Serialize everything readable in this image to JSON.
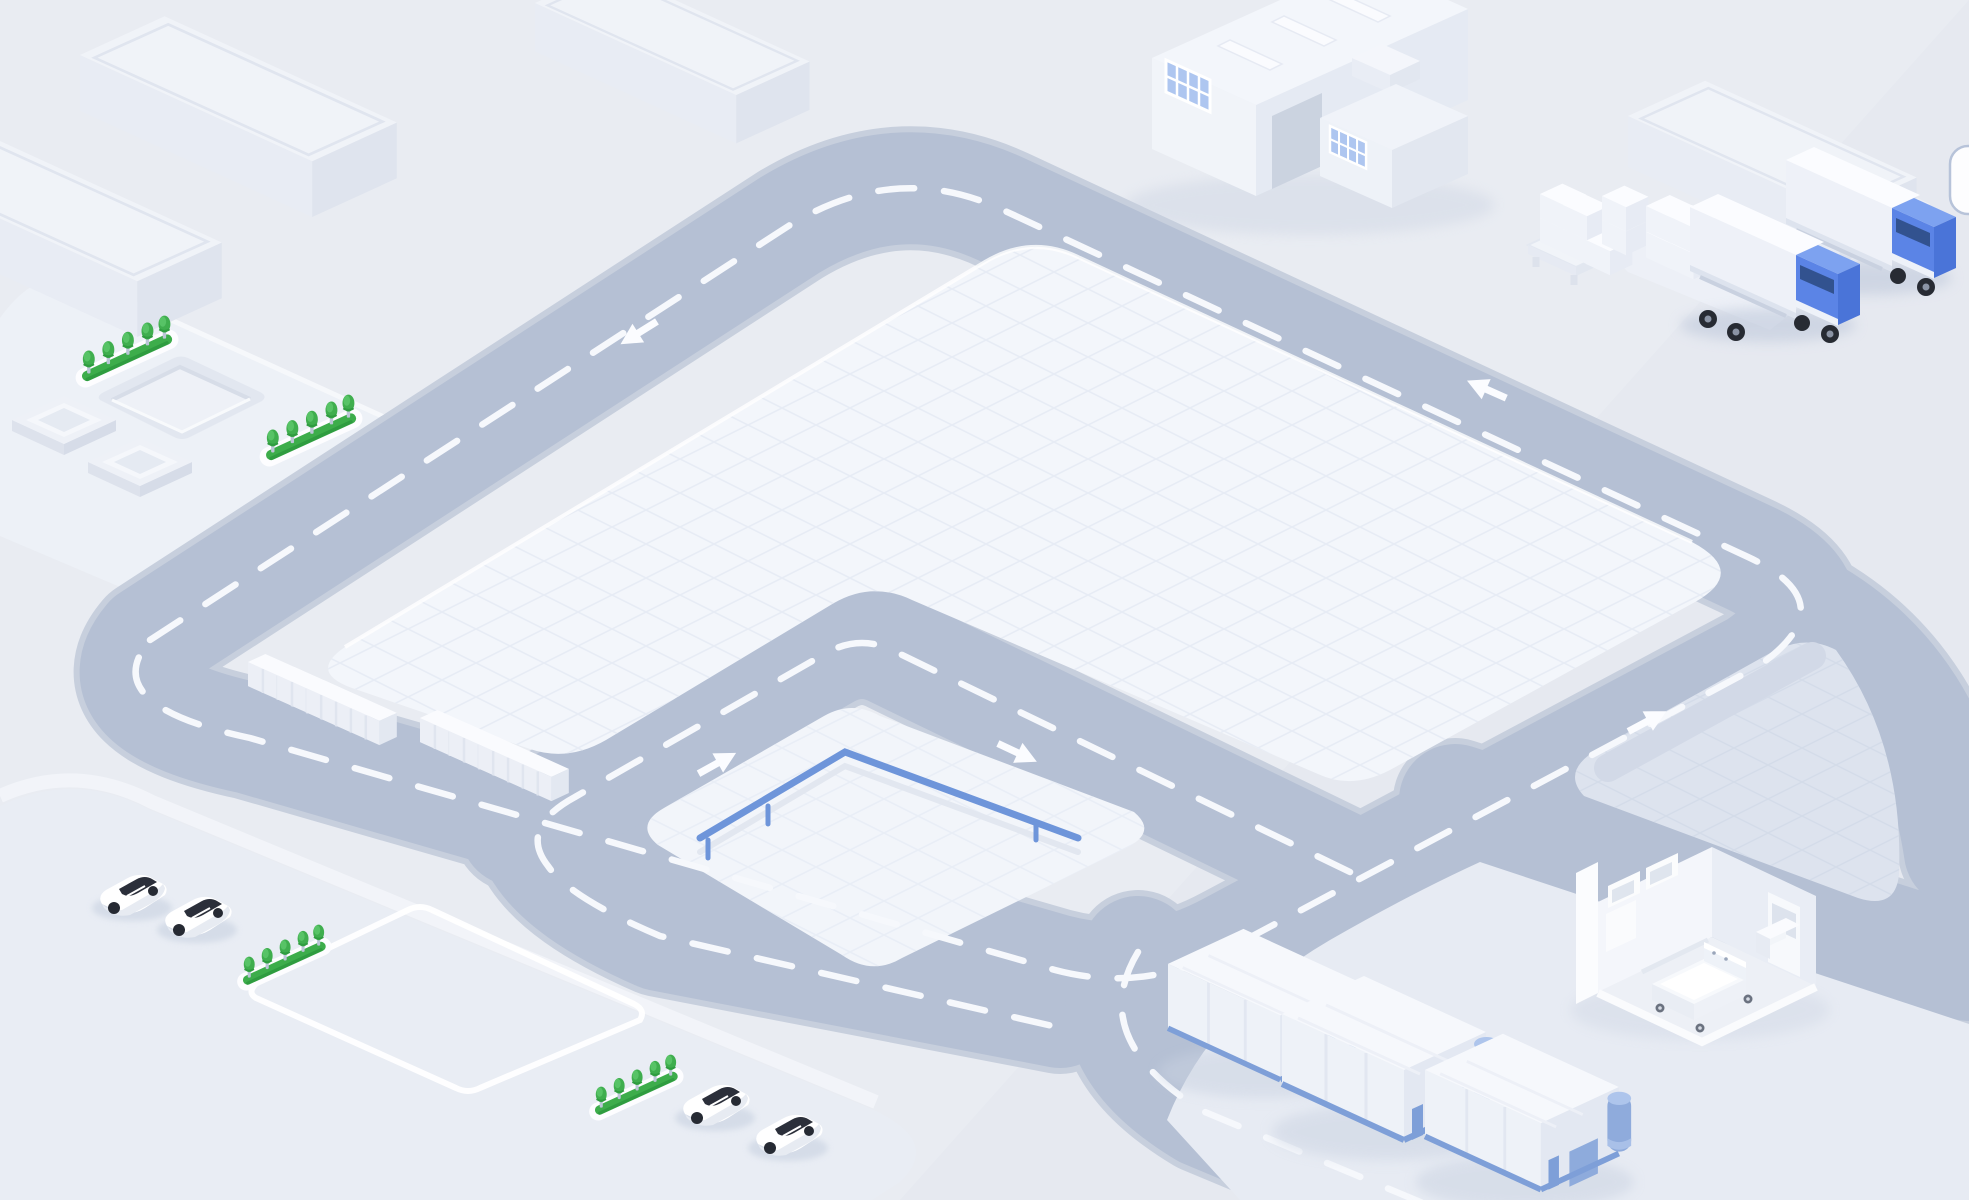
{
  "scene": {
    "title": "isometric-logistics-campus-illustration",
    "palette": {
      "background": "#e9ecf2",
      "road": "#b5c0d4",
      "road_edge": "#c7cfdd",
      "lane_dash": "#f6f8fc",
      "main_pad": "#f3f6fb",
      "pad_grid": "#e7ecf5",
      "inner_pad": "#f2f5fa",
      "right_pad": "#dde3ee",
      "right_pad_grid": "#d2dae8",
      "plot_left": "#edf1f7",
      "plot_bottom_left": "#e9edf4",
      "ground_bottom_right": "#e7ebf3",
      "building_white": "#f0f3f9",
      "building_side": "#e4e9f2",
      "window_blue": "#aec6f0",
      "fence_blue": "#6e95da",
      "truck_blue": "#5b84e6",
      "warehouse_trim_blue": "#7e9fd8",
      "silo_blue": "#8fabdc",
      "tree_green": "#3fae4e",
      "tree_green_dark": "#2f9c40",
      "car_glass": "#2b2f3a",
      "shadow": "#c7d0e0",
      "chip_border": "#b7c3d9"
    },
    "objects": {
      "slab_buildings": {
        "count": 4
      },
      "factory": {
        "window_grids": 2,
        "skylights": 3,
        "rooftop_units": 1
      },
      "pallet_stacks": {
        "pallets": 1,
        "box_stacks": 2
      },
      "trucks": {
        "count": 2,
        "cab_color": "#5b84e6",
        "trailer_color": "#ffffff"
      },
      "tree_strips": {
        "count": 4,
        "trees_per_strip": 5
      },
      "platforms": {
        "count": 2
      },
      "recessed_pad": {
        "count": 1
      },
      "container_groups": {
        "count": 2,
        "containers_each": 3
      },
      "cars": {
        "count": 4,
        "body_color": "#ffffff"
      },
      "warehouses": {
        "count": 3,
        "trim_color": "#7e9fd8"
      },
      "hospital_room": {
        "beds": 1,
        "wheels_visible": 3
      },
      "road_arrows": {
        "count": 5
      },
      "fenced_inner_pad": {
        "fence_color": "#6e95da",
        "posts": 3
      },
      "edge_chip": {
        "position": "right-edge",
        "shape": "rounded-rect"
      }
    }
  }
}
